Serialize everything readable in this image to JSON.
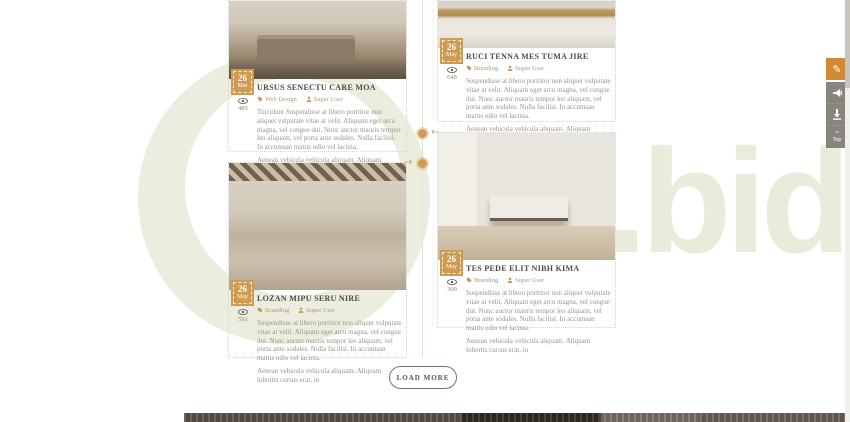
{
  "watermark": {
    "text": ".bid",
    "color": "#e9ecdb"
  },
  "posts": [
    {
      "date_day": "26",
      "date_month": "Mar",
      "title": "URSUS SENECTU CARE MOA",
      "category": "Web Design",
      "author": "Super User",
      "views": "485",
      "excerpt": "Tincidunt Suspendisse at libero porttitor non aliquet vulputate vitae at velit. Aliquam eget arcu magna, vel congue dui. Nunc auctor mauris tempor leo aliquam, vel porta ante sodales. Nulla facilisi. In accumsan mattis odio vel lacinia.",
      "excerpt2": "Aenean vehicula vehicula aliquam. Aliquam lobortis cursus"
    },
    {
      "date_day": "26",
      "date_month": "May",
      "title": "RUCI TENNA MES TUMA JIRE",
      "category": "Branding",
      "author": "Super User",
      "views": "648",
      "excerpt": "Suspendisse at libero porttitor non aliquet vulputate vitae at velit. Aliquam eget arcu magna, vel congue dui. Nunc auctor mauris tempor leo aliquam, vel porta ante sodales. Nulla facilisi. In accumsan mattis odio vel lacinia.",
      "excerpt2": "Aenean vehicula vehicula aliquam. Aliquam lobortis cursus erat, in"
    },
    {
      "date_day": "26",
      "date_month": "May",
      "title": "LOZAN MIPU SERU NIRE",
      "category": "Branding",
      "author": "Super User",
      "views": "591",
      "excerpt": "Suspendisse at libero porttitor non aliquet vulputate vitae at velit. Aliquam eget arcu magna, vel congue dui. Nunc auctor mauris tempor leo aliquam, vel porta ante sodales. Nulla facilisi. In accumsan mattis odio vel lacinia.",
      "excerpt2": "Aenean vehicula vehicula aliquam. Aliquam lobortis cursus erat, in"
    },
    {
      "date_day": "26",
      "date_month": "May",
      "title": "TES PEDE ELIT NIBH KIMA",
      "category": "Branding",
      "author": "Super User",
      "views": "309",
      "excerpt": "Suspendisse at libero porttitor non aliquet vulputate vitae at velit. Aliquam eget arcu magna, vel congue dui. Nunc auctor mauris tempor leo aliquam, vel porta ante sodales. Nulla facilisi. In accumsan mattis odio vel lacinia.",
      "excerpt2": "Aenean vehicula vehicula aliquam. Aliquam lobortis cursus erat, in"
    }
  ],
  "load_more": {
    "label": "LOAD MORE"
  },
  "floating_toolbar": {
    "top_label": "Top"
  },
  "colors": {
    "accent": "#cf9b50",
    "toolbar_orange": "#d08b33",
    "watermark": "#e9ecdb"
  }
}
